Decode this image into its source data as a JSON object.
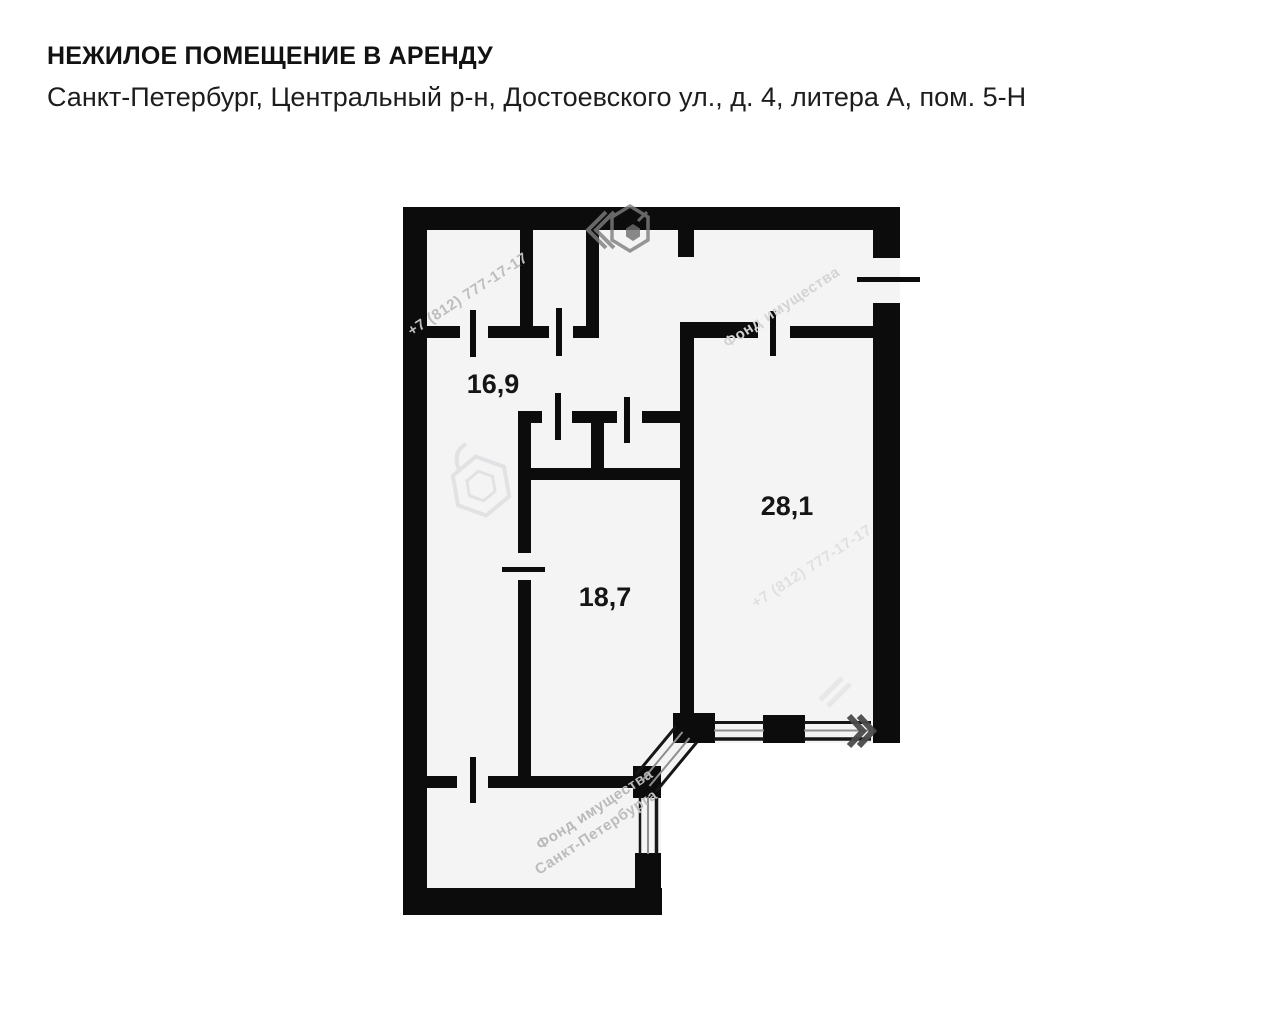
{
  "header": {
    "title": "НЕЖИЛОЕ ПОМЕЩЕНИЕ В АРЕНДУ",
    "address": "Санкт-Петербург, Центральный р-н, Достоевского ул., д. 4, литера А, пом. 5-Н"
  },
  "floor_plan": {
    "rooms": [
      {
        "id": "room-16-9",
        "area_label": "16,9"
      },
      {
        "id": "room-28-1",
        "area_label": "28,1"
      },
      {
        "id": "room-18-7",
        "area_label": "18,7"
      }
    ],
    "features": [
      "entrance-door-right-wall",
      "bay-window-bottom-right",
      "interior-door-openings"
    ],
    "watermarks": {
      "phone": "+7 (812) 777-17-17",
      "org_line1": "Фонд имущества",
      "org_line2": "Санкт-Петербурга"
    },
    "colors": {
      "wall": "#0c0c0c",
      "floor": "#f4f4f5",
      "glazing_dark": "#161616",
      "glazing_light": "#8f8f8f",
      "watermark_light": "#d9d9db",
      "watermark_dark": "#4a4a4a"
    }
  }
}
